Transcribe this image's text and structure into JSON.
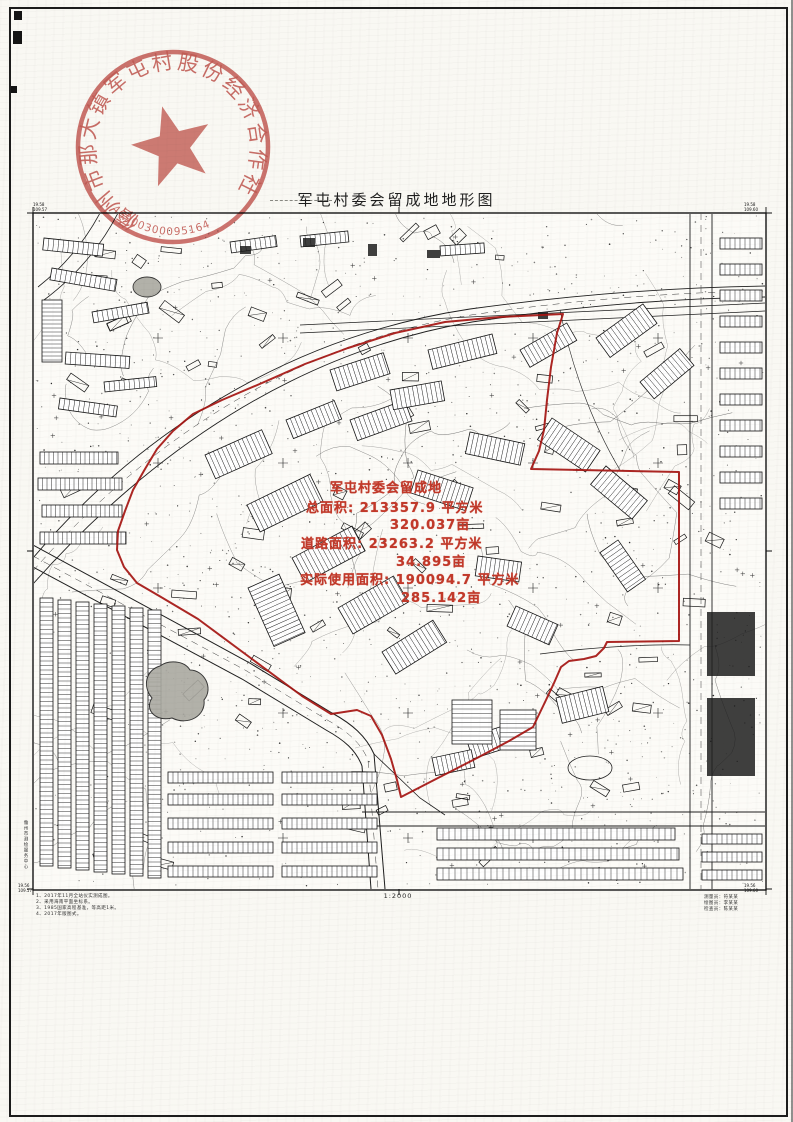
{
  "document": {
    "title": "军屯村委会留成地地形图",
    "scale_label": "1:2000"
  },
  "seal": {
    "ring_text": "儋州市那大镇军屯村股份经济合作社",
    "serial": "46900300095164",
    "color": "#bf4a44"
  },
  "annotation": {
    "color": "#c2392a",
    "lines": [
      "军屯村委会留成地",
      "总面积: 213357.9 平方米",
      "320.037亩",
      "道路面积: 23263.2 平方米",
      "34.895亩",
      "实际使用面积: 190094.7 平方米",
      "285.142亩"
    ]
  },
  "boundary": {
    "color": "#a51310",
    "stroke_width": 2,
    "points": [
      [
        563,
        314
      ],
      [
        500,
        317
      ],
      [
        445,
        322
      ],
      [
        395,
        333
      ],
      [
        348,
        348
      ],
      [
        305,
        364
      ],
      [
        262,
        383
      ],
      [
        222,
        400
      ],
      [
        193,
        414
      ],
      [
        173,
        431
      ],
      [
        157,
        449
      ],
      [
        145,
        469
      ],
      [
        133,
        490
      ],
      [
        125,
        511
      ],
      [
        118,
        531
      ],
      [
        117,
        550
      ],
      [
        124,
        567
      ],
      [
        137,
        583
      ],
      [
        161,
        597
      ],
      [
        198,
        619
      ],
      [
        252,
        659
      ],
      [
        302,
        696
      ],
      [
        331,
        714
      ],
      [
        357,
        710
      ],
      [
        371,
        716
      ],
      [
        382,
        735
      ],
      [
        391,
        759
      ],
      [
        397,
        780
      ],
      [
        401,
        797
      ],
      [
        436,
        779
      ],
      [
        477,
        758
      ],
      [
        509,
        741
      ],
      [
        533,
        727
      ],
      [
        546,
        700
      ],
      [
        554,
        683
      ],
      [
        561,
        667
      ],
      [
        569,
        661
      ],
      [
        584,
        659
      ],
      [
        596,
        656
      ],
      [
        604,
        648
      ],
      [
        607,
        642
      ],
      [
        679,
        641
      ],
      [
        679,
        472
      ],
      [
        531,
        469
      ],
      [
        539,
        451
      ],
      [
        544,
        430
      ],
      [
        547,
        400
      ],
      [
        551,
        367
      ],
      [
        557,
        333
      ]
    ]
  },
  "footnotes": {
    "left_lines": [
      "1、2017年11月全站仪实测成图。",
      "2、采用海南平面坐标系。",
      "3、1985国家高程基准，等高距1米。",
      "4、2017年版图式。"
    ],
    "right_lines": [
      "测量员：符某某",
      "绘图员：李某某",
      "检查员：陈某某"
    ]
  },
  "corner_labels": {
    "top_left": [
      "19.58",
      "109.57"
    ],
    "top_right": [
      "19.58",
      "109.60"
    ],
    "bottom_left": [
      "19.56",
      "109.57"
    ],
    "bottom_right": [
      "19.56",
      "109.60"
    ]
  },
  "side_label": "儋州市测绘服务中心"
}
